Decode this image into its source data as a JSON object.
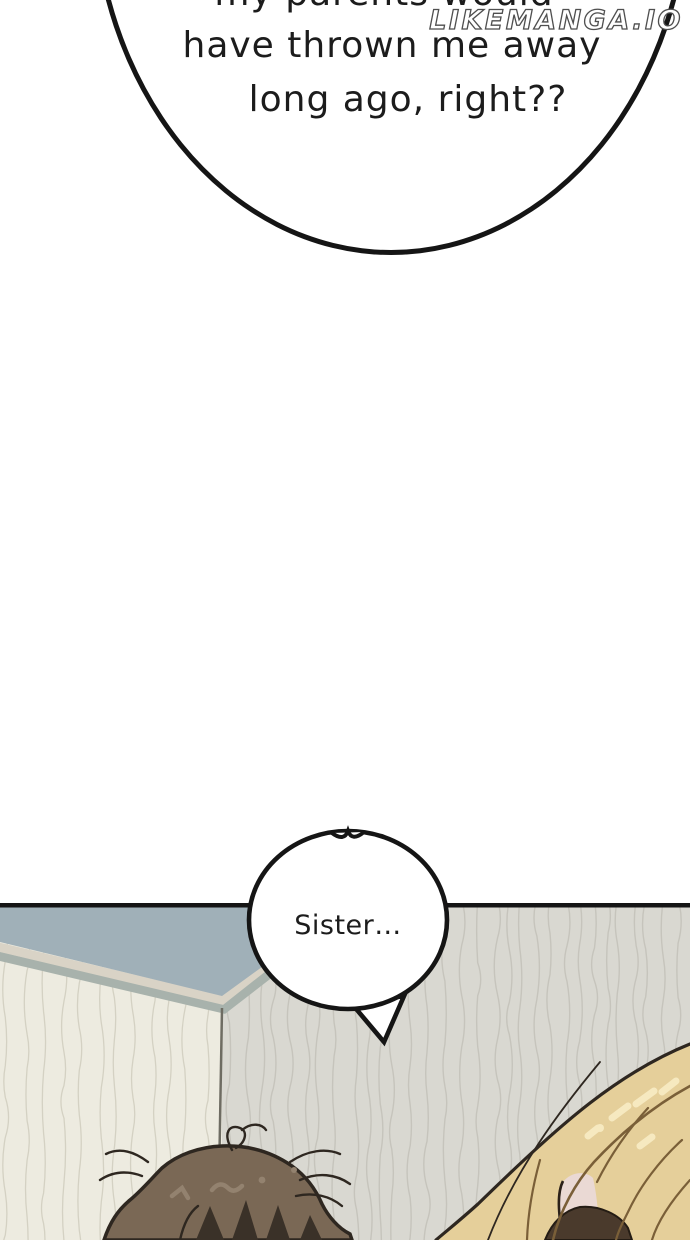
{
  "watermark": {
    "text": "LIKEMANGA.IO"
  },
  "panel": {
    "top_bubble": {
      "line1": "my parents would",
      "line2": "have thrown me away",
      "line3": "long ago, right??"
    },
    "bottom_bubble": {
      "text": "Sister…"
    }
  },
  "colors": {
    "outline": "#151515",
    "ceiling": "#a0b0b8",
    "trim_light": "#d9d3c6",
    "trim_dark": "#a8b2ac",
    "wall_left": "#edebe0",
    "wall_right": "#d9d8d1",
    "texture_left": "#cfccbd",
    "texture_right": "#c2c1b8",
    "hair_brown": "#7a6855",
    "hair_brown_shadow": "#3a3128",
    "hair_brown_hl": "#93826f",
    "line_dark": "#2e2720",
    "hair_blonde": "#e5cf9a",
    "hair_blonde_strand": "#7a5f38",
    "hair_blonde_hl": "#f6e9c0",
    "skin": "#ead9d4",
    "hair_dark_wedge": "#4a3a2c"
  }
}
